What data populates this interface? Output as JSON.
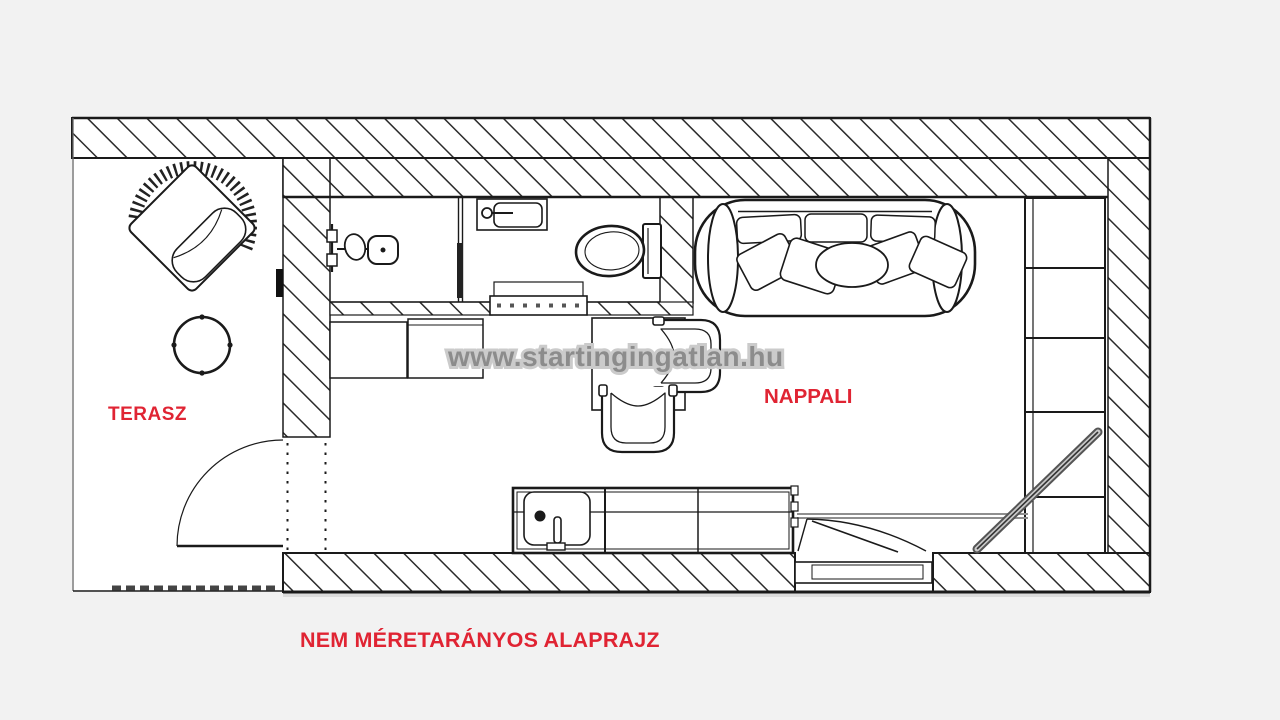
{
  "background_color": "#f2f2f2",
  "plan": {
    "floor_color": "#ffffff",
    "wall_line_color": "#1a1a1a",
    "hatch_color": "#2b2b2b",
    "furniture": [
      "wicker-armchair",
      "round-side-table",
      "shower-set",
      "shower-glass",
      "washbasin",
      "toilet",
      "sliding-door",
      "bath-mat",
      "sofa-with-pillows",
      "shelving-unit",
      "desk",
      "desk-chair-right",
      "desk-chair-bottom",
      "kitchen-counter",
      "kitchen-sink",
      "loft-edge",
      "ladder",
      "terrace-door",
      "entry-door",
      "outdoor-step"
    ]
  },
  "labels": {
    "terrace": "TERASZ",
    "living_room": "NAPPALI",
    "disclaimer": "NEM MÉRETARÁNYOS ALAPRAJZ",
    "color": "#e02433"
  },
  "watermark": {
    "text": "www.startingingatlan.hu",
    "fill": "#8c8c8c",
    "outline": "#cbcbcb"
  }
}
